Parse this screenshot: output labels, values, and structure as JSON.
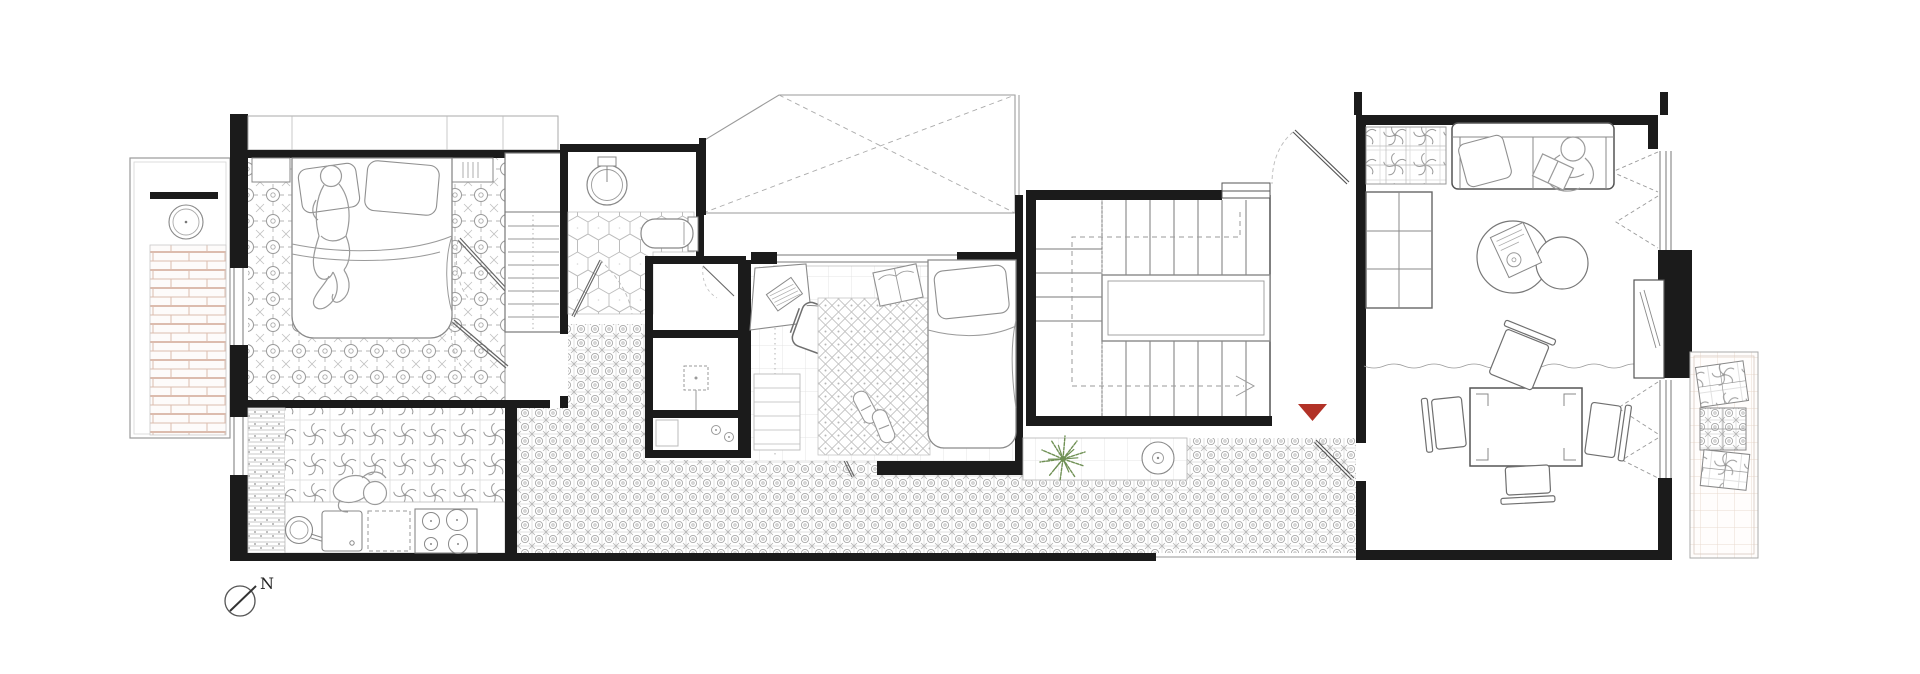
{
  "document": {
    "kind": "architectural-floor-plan",
    "background": "#ffffff"
  },
  "north_arrow": {
    "label": "N"
  },
  "entrance_marker": {
    "shape": "triangle-down",
    "color": "#b23227"
  },
  "palette": {
    "wall": "#1b1b1b",
    "line": "#9a9a9a",
    "line_dark": "#555555",
    "line_light": "#c9c9c9",
    "brick": "#dcbcae",
    "terrace": "#eadacf",
    "plant": "#6f9054",
    "paper": "#ffffff"
  },
  "rooms": [
    "street-balcony",
    "master-bedroom",
    "wardrobe",
    "bathroom",
    "skylight-void",
    "utility-rooms",
    "hallway",
    "kitchen",
    "study-bedroom",
    "corridor",
    "courtyard",
    "staircase",
    "entry-vestibule",
    "living-dining-room",
    "rear-balcony"
  ],
  "furniture": [
    "round-balcony-table",
    "double-bed",
    "pillows",
    "wardrobe-shelves",
    "washbasin",
    "toilet",
    "desk",
    "desk-chair",
    "single-bed",
    "rug",
    "slippers",
    "open-book",
    "cooktop",
    "kitchen-sink",
    "pot",
    "dishwasher",
    "stair-treads",
    "stair-void",
    "plant",
    "patio-table",
    "sofa",
    "cushion",
    "coffee-tables",
    "magazine",
    "wall-shelving",
    "dining-table",
    "dining-chairs",
    "sideboard",
    "tile-samples"
  ],
  "people": [
    "person-sleeping",
    "person-cooking",
    "person-reading"
  ]
}
